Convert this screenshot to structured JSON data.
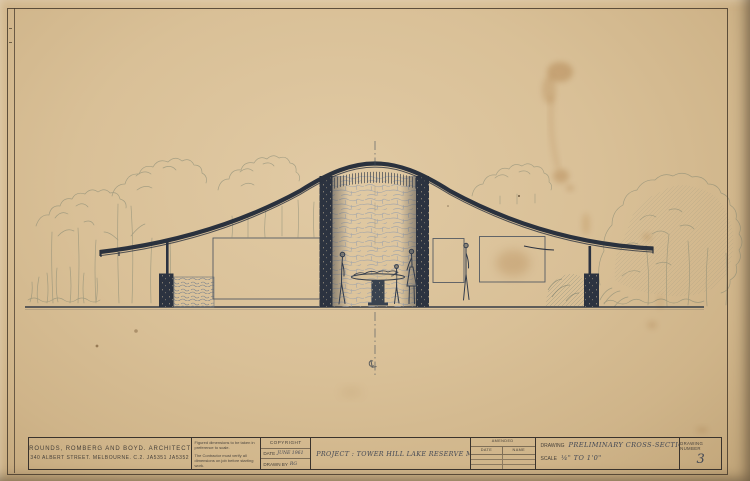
{
  "sheet": {
    "architects": {
      "line1": "GROUNDS, ROMBERG AND BOYD. ARCHITECTS",
      "line2": "340 ALBERT STREET. MELBOURNE. C.2. JA5351 JA5352"
    },
    "notes": {
      "line1": "Figured dimensions to be taken in preference to scale.",
      "line2": "The Contractor must verify all dimensions on job before starting work."
    },
    "copyright": {
      "header": "COPYRIGHT",
      "date_label": "DATE",
      "date_value": "JUNE 1961",
      "drawn_by_label": "DRAWN BY",
      "drawn_by_value": "RG"
    },
    "project": {
      "text": "PROJECT : TOWER HILL LAKE RESERVE MUSEUM"
    },
    "amended": {
      "header": "AMENDED",
      "col_date": "DATE",
      "col_name": "NAME"
    },
    "drawing": {
      "label": "DRAWING",
      "value": "PRELIMINARY CROSS-SECTION",
      "scale_label": "SCALE",
      "scale_value": "¼\" TO 1'0\""
    },
    "number": {
      "label": "DRAWING NUMBER",
      "value": "3"
    },
    "annotation": {
      "centerline_symbol": "℄"
    }
  },
  "colors": {
    "paper": "#d9c097",
    "ink": "#2a313d",
    "pencil": "#79816f",
    "stain": "#b5813f",
    "border": "#3a332c"
  }
}
